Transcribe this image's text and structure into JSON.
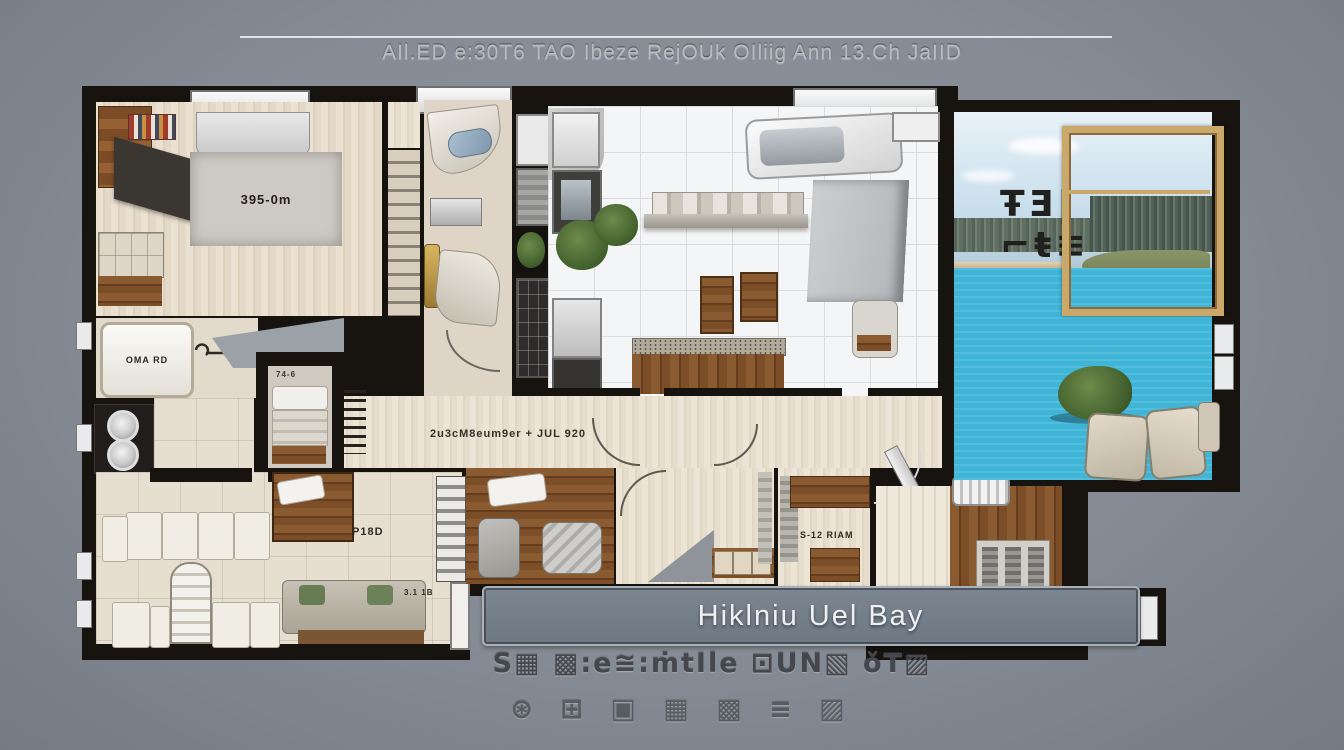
{
  "background": {
    "color": "#878d96"
  },
  "header": {
    "title": "AIl.ED e:30T6 TAO Ibeze RejOUk OIliig Ann 13.Ch JaIID"
  },
  "floorplan": {
    "labels": {
      "master_rug": "395-0m",
      "bathroom": "OMA RD",
      "laundry": "+8 RD",
      "living": "P18D",
      "living_door": "3.1 1B",
      "hallway": "2u3cM8eum9er + JUL 920",
      "elevator": "74-6",
      "study": "S-12 RIAM",
      "tile_room": "T.18 W",
      "window_glyphs": "ŦƎ|⌐ŧ≡"
    },
    "colors": {
      "wall": "#17140f",
      "wood_light": "#e6dccc",
      "wood_dark": "#7a4f2a",
      "kitchen_tile": "#f4f5f6",
      "pool_water": "#3fb6d8",
      "window_frame_gold": "#c9a86a",
      "banner_bg": "#717c87"
    }
  },
  "banner": {
    "text": "Hiklniu Uel Bay"
  },
  "footer": {
    "line1": "S▦ ▩:e≅:ṁtIle ⊡UN▧ ǒT▨",
    "line2": "⊛ ⊞ ▣ ▦ ▩ ≡ ▨"
  }
}
